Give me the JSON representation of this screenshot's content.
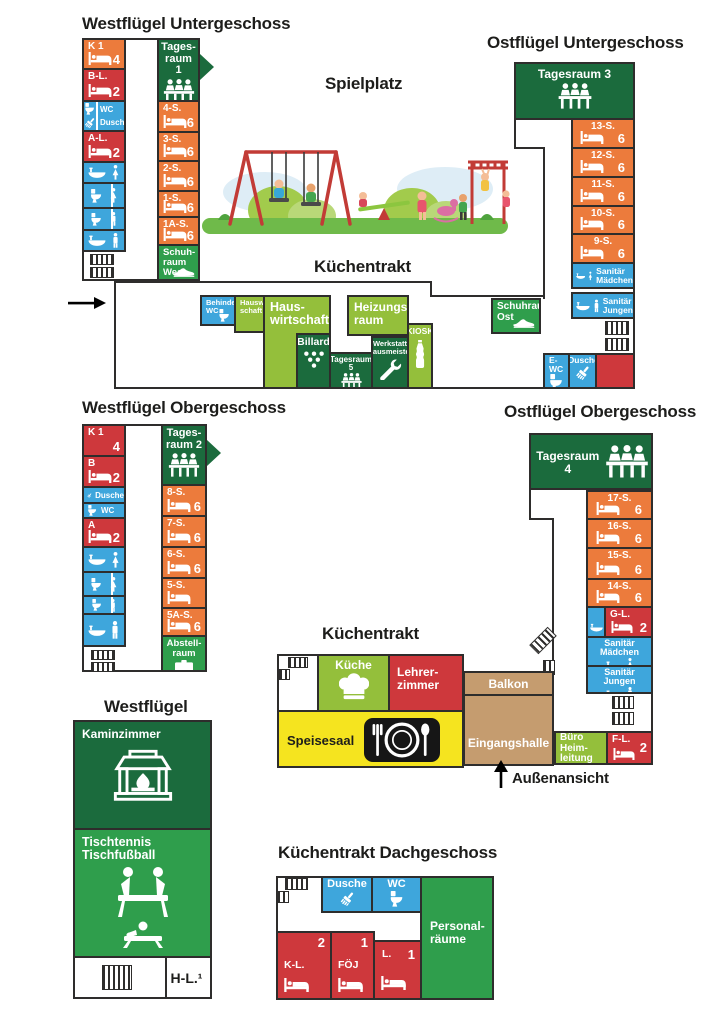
{
  "colors": {
    "orange": "#EC7B3C",
    "red": "#CE383C",
    "blue": "#3EA6DC",
    "dark_green": "#1B6B3D",
    "mid_green": "#2F9E4C",
    "light_green": "#94BF3B",
    "yellow": "#F5E41F",
    "tan": "#C59C6F",
    "outline": "#2E2D2C"
  },
  "titles": {
    "west_ug": "Westflügel Untergeschoss",
    "ost_ug": "Ostflügel Untergeschoss",
    "spielplatz": "Spielplatz",
    "kuechentrakt_ug": "Küchentrakt",
    "west_og": "Westflügel Obergeschoss",
    "ost_og": "Ostflügel Obergeschoss",
    "kuechentrakt": "Küchentrakt",
    "westfluegel": "Westflügel",
    "kuechentrakt_dach": "Küchentrakt Dachgeschoss",
    "aussenansicht": "Außenansicht"
  },
  "west_ug": {
    "k1": {
      "label": "K 1",
      "beds": "4",
      "icon": "bed"
    },
    "bl": {
      "label": "B-L.",
      "beds": "2",
      "icon": "bed"
    },
    "wc_dusche": {
      "wc": "WC",
      "dusche": "Dusche",
      "icons": [
        "toilet",
        "shower-brush"
      ]
    },
    "al": {
      "label": "A-L.",
      "beds": "2",
      "icon": "bed"
    },
    "sanitary_icons": [
      [
        "washbasin",
        "woman"
      ],
      [
        "toilet",
        "woman"
      ],
      [
        "toilet",
        "man"
      ],
      [
        "washbasin",
        "man"
      ]
    ],
    "tagesraum": {
      "label": "Tages-\nraum 1",
      "icon": "group-table"
    },
    "rooms": [
      {
        "label": "4-S.",
        "beds": "6",
        "icon": "bed"
      },
      {
        "label": "3-S.",
        "beds": "6",
        "icon": "bed"
      },
      {
        "label": "2-S.",
        "beds": "6",
        "icon": "bed"
      },
      {
        "label": "1-S.",
        "beds": "6",
        "icon": "bed"
      },
      {
        "label": "1A-S.",
        "beds": "6",
        "icon": "bed"
      }
    ],
    "schuhraum": {
      "label": "Schuh-\nraum\nWest",
      "icon": "shoe"
    }
  },
  "ost_ug": {
    "tagesraum": {
      "label": "Tagesraum 3",
      "icon": "group-table"
    },
    "rooms": [
      {
        "label": "13-S.",
        "beds": "6",
        "icon": "bed"
      },
      {
        "label": "12-S.",
        "beds": "6",
        "icon": "bed"
      },
      {
        "label": "11-S.",
        "beds": "6",
        "icon": "bed"
      },
      {
        "label": "10-S.",
        "beds": "6",
        "icon": "bed"
      },
      {
        "label": "9-S.",
        "beds": "6",
        "icon": "bed"
      }
    ],
    "san_maedchen": {
      "label": "Sanitär\nMädchen",
      "icons": [
        "washbasin",
        "woman"
      ]
    },
    "san_jungen": {
      "label": "Sanitär\nJungen",
      "icons": [
        "washbasin",
        "man"
      ]
    },
    "schuhraum": {
      "label": "Schuhraum\nOst",
      "icon": "shoe"
    }
  },
  "mittelbau": {
    "behinderten_wc": {
      "label": "Behinderten\nWC",
      "icon": "toilet"
    },
    "hauswirtschaft_klein": {
      "label": "Hauswirt-\nschaft"
    },
    "hauswirtschaft": {
      "label": "Haus-\nwirtschaft"
    },
    "billard": {
      "label": "Billard",
      "icon": "billiard"
    },
    "tagesraum5": {
      "label": "Tagesraum 5",
      "icon": "group-table"
    },
    "heizungsraum": {
      "label": "Heizungs-\nraum"
    },
    "werkstatt": {
      "label": "Werkstatt\nHausmeister",
      "icon": "wrench"
    },
    "kiosk": {
      "label": "KIOSK",
      "icon": "bottle"
    },
    "e_wc": {
      "label": "E-WC",
      "icon": "toilet"
    },
    "dusche": {
      "label": "Dusche",
      "icon": "shower-brush"
    }
  },
  "west_og": {
    "k1": {
      "label": "K 1",
      "beds": "4"
    },
    "b": {
      "label": "B",
      "beds": "2",
      "icon": "bed"
    },
    "dusche": {
      "label": "Dusche",
      "icon": "shower-brush"
    },
    "wc": {
      "label": "WC",
      "icon": "toilet"
    },
    "a": {
      "label": "A",
      "beds": "2",
      "icon": "bed"
    },
    "sanitary_icons": [
      [
        "washbasin",
        "woman"
      ],
      [
        "toilet",
        "woman"
      ],
      [
        "toilet",
        "man"
      ],
      [
        "washbasin",
        "man"
      ]
    ],
    "tagesraum": {
      "label": "Tages-\nraum 2",
      "icon": "group-table"
    },
    "rooms": [
      {
        "label": "8-S.",
        "beds": "6",
        "icon": "bed"
      },
      {
        "label": "7-S.",
        "beds": "6",
        "icon": "bed"
      },
      {
        "label": "6-S.",
        "beds": "6",
        "icon": "bed"
      },
      {
        "label": "5-S.",
        "beds": "",
        "icon": "bed"
      },
      {
        "label": "5A-S.",
        "beds": "6",
        "icon": "bed"
      }
    ],
    "abstellraum": {
      "label": "Abstell-\nraum",
      "icon": "suitcase"
    }
  },
  "ost_og": {
    "tagesraum": {
      "label": "Tagesraum\n4",
      "icon": "group-table"
    },
    "rooms": [
      {
        "label": "17-S.",
        "beds": "6",
        "icon": "bed"
      },
      {
        "label": "16-S.",
        "beds": "6",
        "icon": "bed"
      },
      {
        "label": "15-S.",
        "beds": "6",
        "icon": "bed"
      },
      {
        "label": "14-S.",
        "beds": "6",
        "icon": "bed"
      }
    ],
    "gl": {
      "label": "G-L.",
      "beds": "2",
      "icon": "bed"
    },
    "gl_washroom_icon": "washbasin",
    "san_maedchen": {
      "label": "Sanitär Mädchen",
      "icons": [
        "washbasin",
        "woman"
      ]
    },
    "san_jungen": {
      "label": "Sanitär Jungen",
      "icons": [
        "washbasin",
        "man"
      ]
    },
    "balkon": {
      "label": "Balkon"
    },
    "eingangshalle": {
      "label": "Eingangshalle"
    },
    "buero": {
      "label": "Büro Heim-\nleitung"
    },
    "fl": {
      "label": "F-L.",
      "beds": "2",
      "icon": "bed"
    }
  },
  "kuechentrakt": {
    "kueche": {
      "label": "Küche",
      "icon": "chef-hat"
    },
    "lehrerzimmer": {
      "label": "Lehrer-\nzimmer"
    },
    "speisesaal": {
      "label": "Speisesaal",
      "icon": "dining"
    }
  },
  "westfluegel": {
    "kaminzimmer": {
      "label": "Kaminzimmer",
      "icon": "fireplace"
    },
    "spiele": {
      "label": "Tischtennis\nTischfußball",
      "icon": "games"
    },
    "hl": {
      "label": "H-L.¹"
    }
  },
  "dachgeschoss": {
    "dusche": {
      "label": "Dusche",
      "icon": "shower-brush"
    },
    "wc": {
      "label": "WC",
      "icon": "toilet"
    },
    "personalraeume": {
      "label": "Personal-\nräume"
    },
    "kl": {
      "label": "K-L.",
      "beds": "2",
      "icon": "bed"
    },
    "foej": {
      "label": "FÖJ",
      "beds": "1",
      "icon": "bed"
    },
    "l": {
      "label": "L.",
      "beds": "1",
      "icon": "bed"
    }
  }
}
